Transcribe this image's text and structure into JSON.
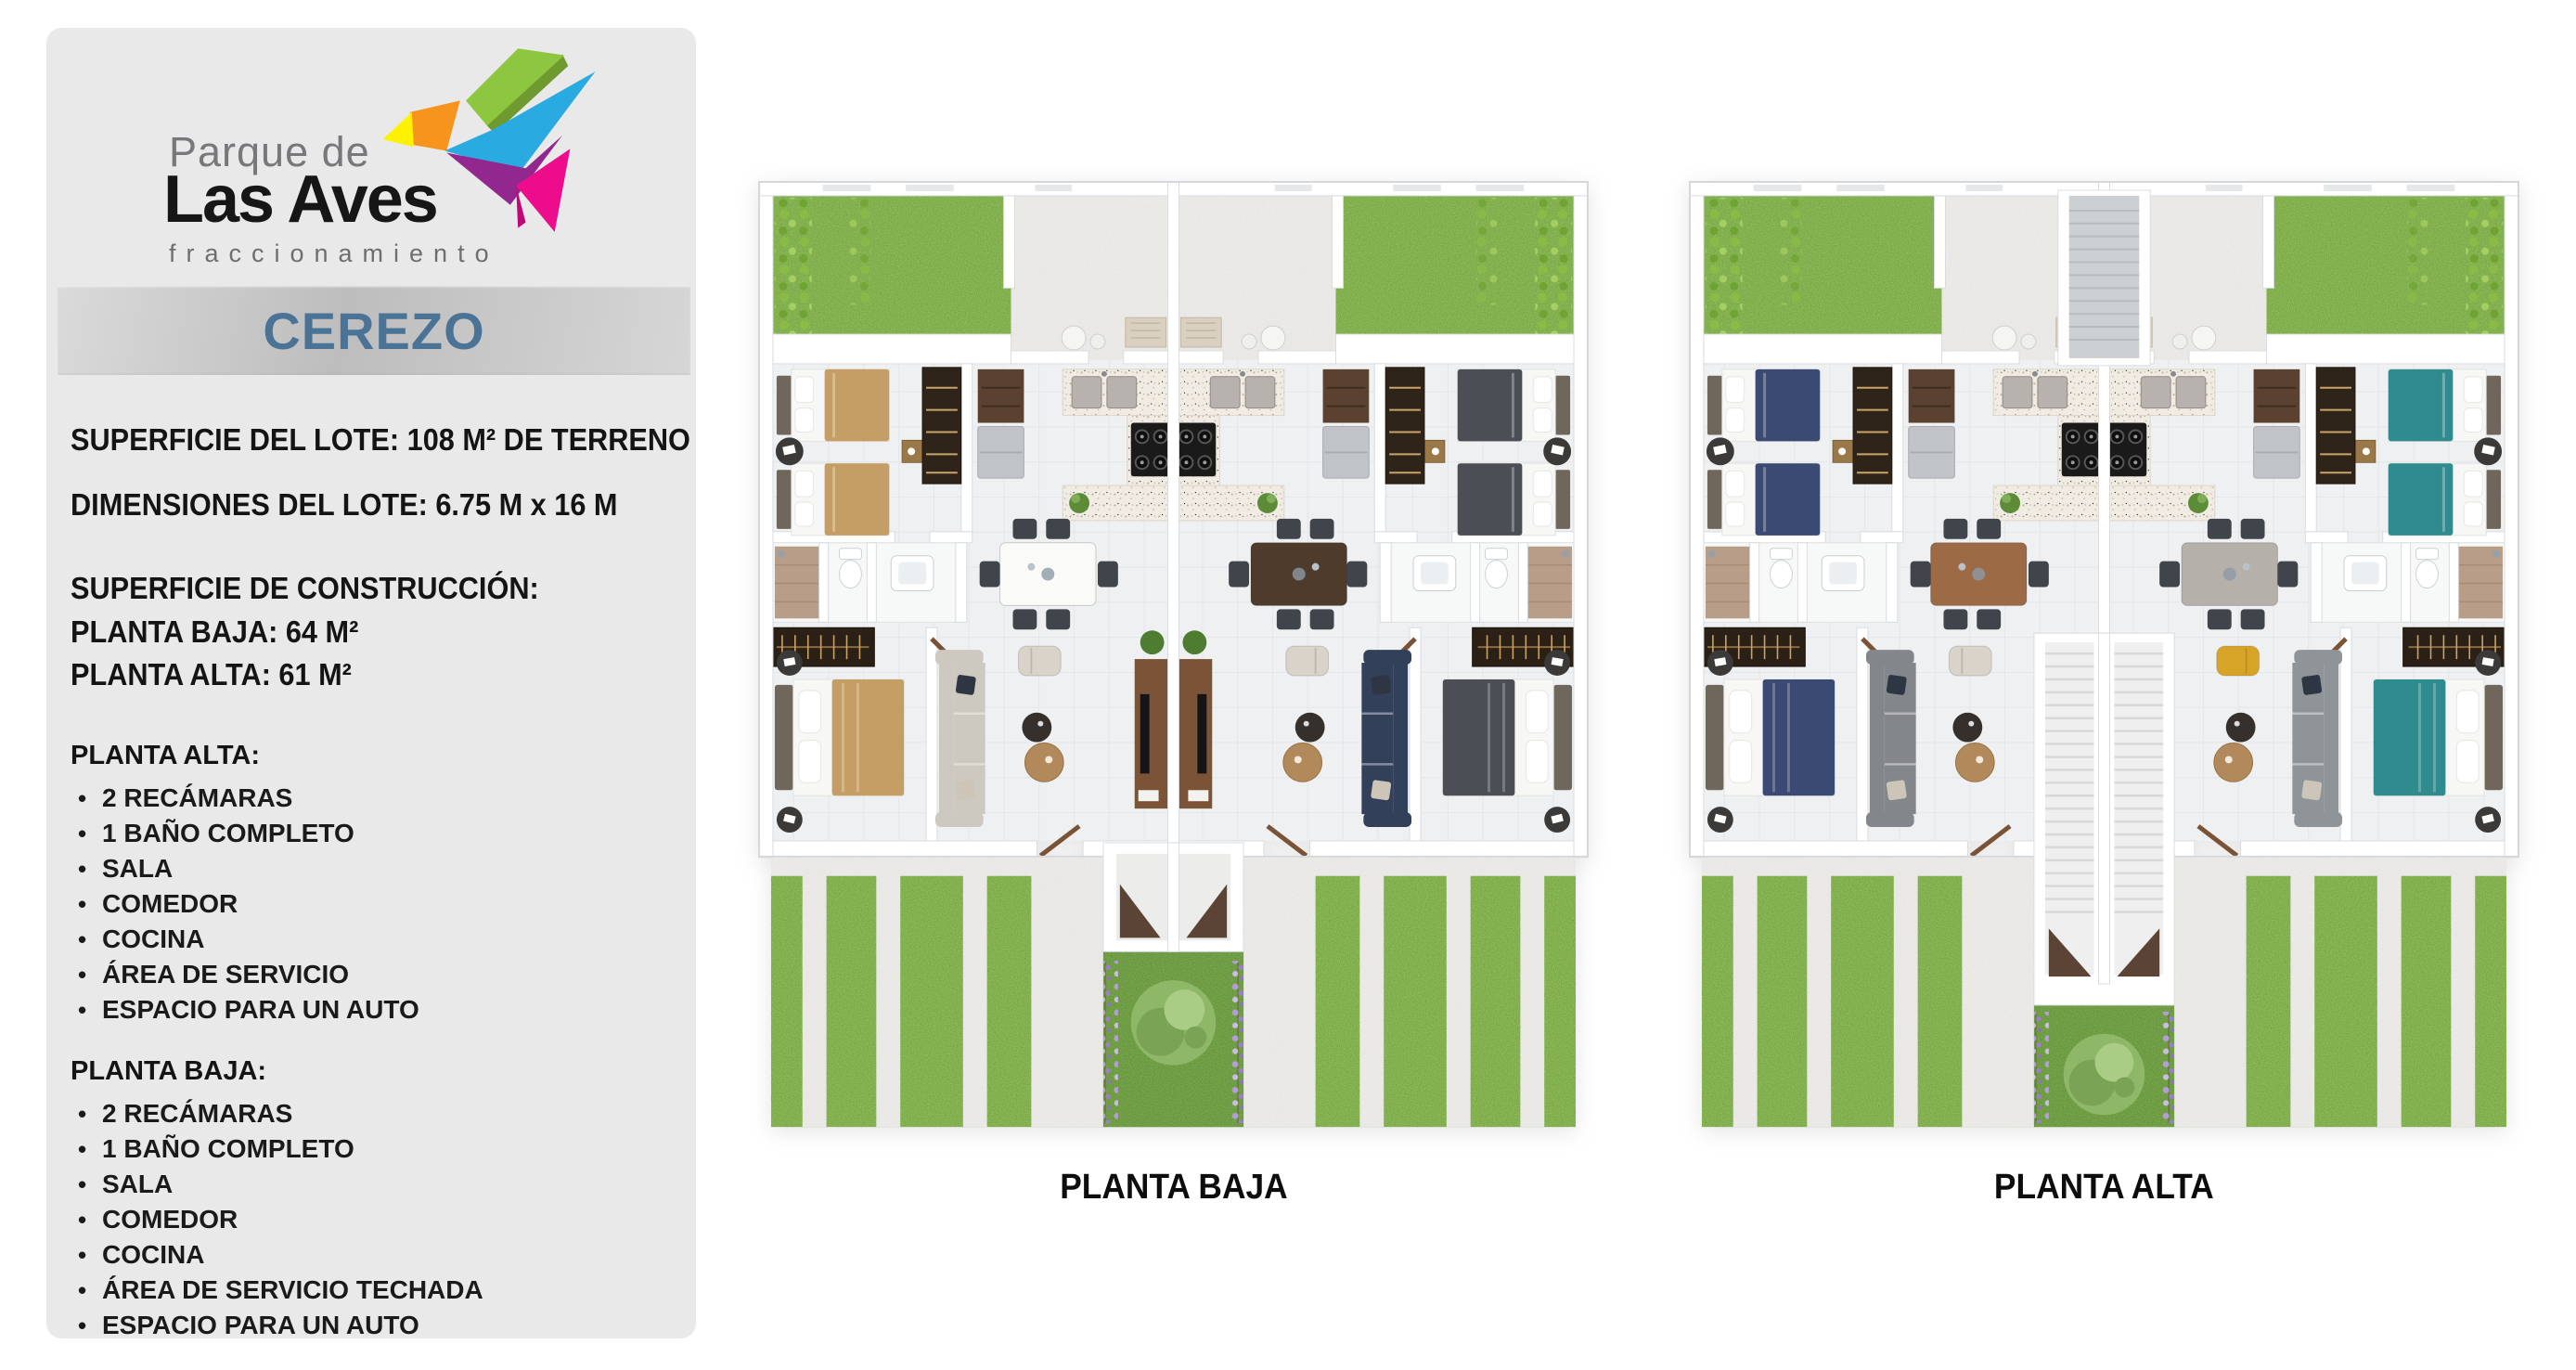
{
  "logo": {
    "line1": "Parque de",
    "line2": "Las Aves",
    "line3": "fraccionamiento"
  },
  "model": {
    "name": "CEREZO"
  },
  "specs": {
    "lot_surface": "SUPERFICIE DEL LOTE: 108 M² DE TERRENO",
    "lot_dimensions": "DIMENSIONES DEL LOTE: 6.75 M x 16 M",
    "construction_title": "SUPERFICIE DE CONSTRUCCIÓN:",
    "construction_ground": "PLANTA BAJA: 64 M²",
    "construction_upper": "PLANTA ALTA: 61 M²"
  },
  "features_upper": {
    "title": "PLANTA ALTA:",
    "items": [
      "2 RECÁMARAS",
      "1 BAÑO COMPLETO",
      "SALA",
      "COMEDOR",
      "COCINA",
      "ÁREA DE SERVICIO",
      "ESPACIO PARA UN AUTO"
    ]
  },
  "features_ground": {
    "title": "PLANTA BAJA:",
    "items": [
      "2 RECÁMARAS",
      "1 BAÑO COMPLETO",
      "SALA",
      "COMEDOR",
      "COCINA",
      "ÁREA DE SERVICIO TECHADA",
      "ESPACIO PARA UN AUTO"
    ]
  },
  "plans": {
    "ground_label": "PLANTA BAJA",
    "upper_label": "PLANTA ALTA"
  },
  "colors": {
    "panel_bg": "#e9e9e9",
    "model_text": "#4a7396",
    "model_bar": [
      "#dadada",
      "#bdbdbd",
      "#d6d6d6"
    ],
    "logo_bird": {
      "green": "#8dc63f",
      "blue": "#29abe2",
      "orange": "#f7941e",
      "yellow": "#fff200",
      "purple": "#92278f",
      "pink": "#ec0c8c"
    },
    "grass": "#4d681c",
    "concrete": "#d6d4d1",
    "beds": {
      "ground_left": "#c59e66",
      "ground_right": "#4b4e55",
      "upper_left": "#3b4a72",
      "upper_right": "#2f8b8e"
    }
  }
}
